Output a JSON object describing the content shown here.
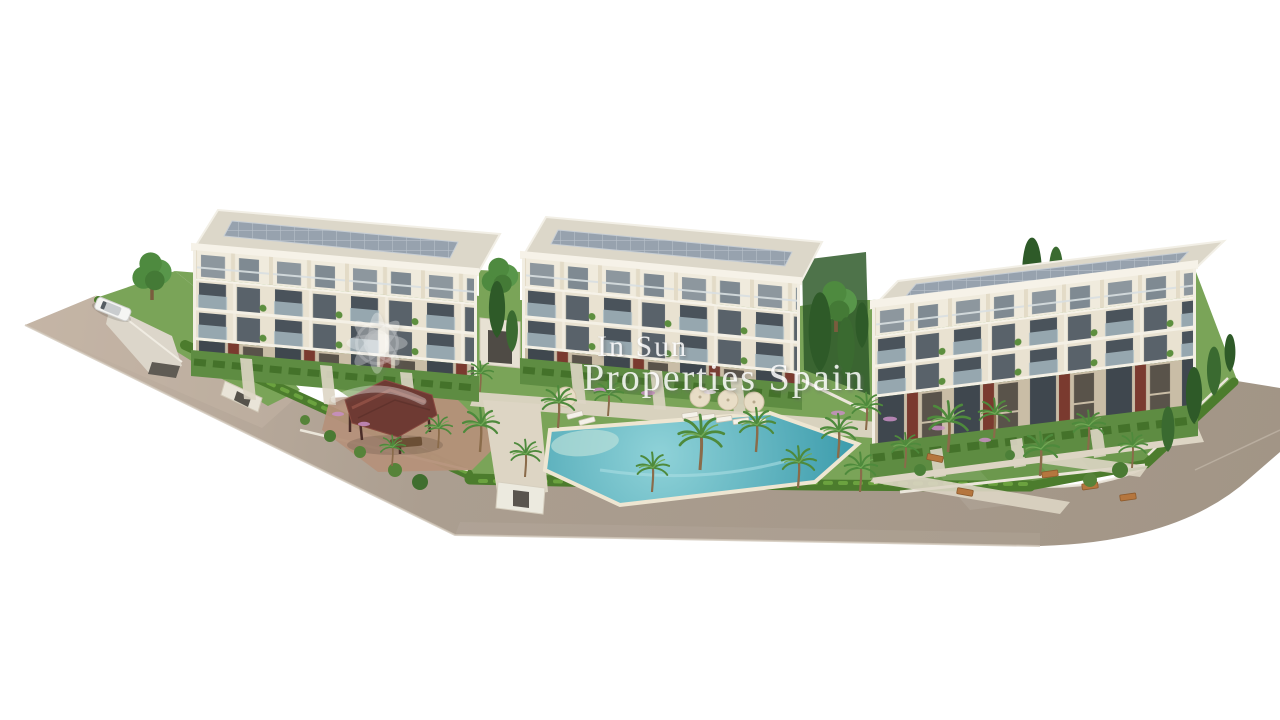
{
  "scene": {
    "type": "3D architectural aerial render",
    "subject": "Residential complex of three modern apartment buildings with communal pool and gardens",
    "elements": [
      "perimeter-road",
      "driveway-ramp",
      "white-car",
      "entrance-gate",
      "apartment-building-1",
      "apartment-building-2",
      "apartment-building-3",
      "rooftop-solar-panels",
      "swimming-pool",
      "pool-deck",
      "pergola",
      "picnic-table",
      "sun-loungers",
      "parasols",
      "palm-trees",
      "cypress-trees",
      "boundary-hedge",
      "perimeter-wall",
      "lawns",
      "flower-beds",
      "garden-benches"
    ],
    "colors": {
      "background": "#ffffff",
      "road": "#a99c8e",
      "road_light": "#c6b6a7",
      "curb": "#ece7dc",
      "lawn": "#7aa458",
      "lawn_dark": "#5e8c42",
      "hedge": "#4c7c2d",
      "path": "#ddd5c4",
      "deck": "#d5ccba",
      "dirt": "#b5917a",
      "pool": "#4fa5b2",
      "pool_light": "#8fd2d8",
      "facade": "#e9e2d1",
      "roof": "#dcd7c9",
      "solar": "#97a2ae",
      "accent_red": "#7a3a2f",
      "pergola": "#6e3a33",
      "foliage": "#4e8a3c",
      "cypress": "#2e5a28",
      "umbrella": "#e8ddc6",
      "wall": "#ebe6da"
    }
  },
  "watermark": {
    "logo": "in-sun-flower-logo",
    "line1": "In Sun",
    "line2": "Properties Spain"
  }
}
